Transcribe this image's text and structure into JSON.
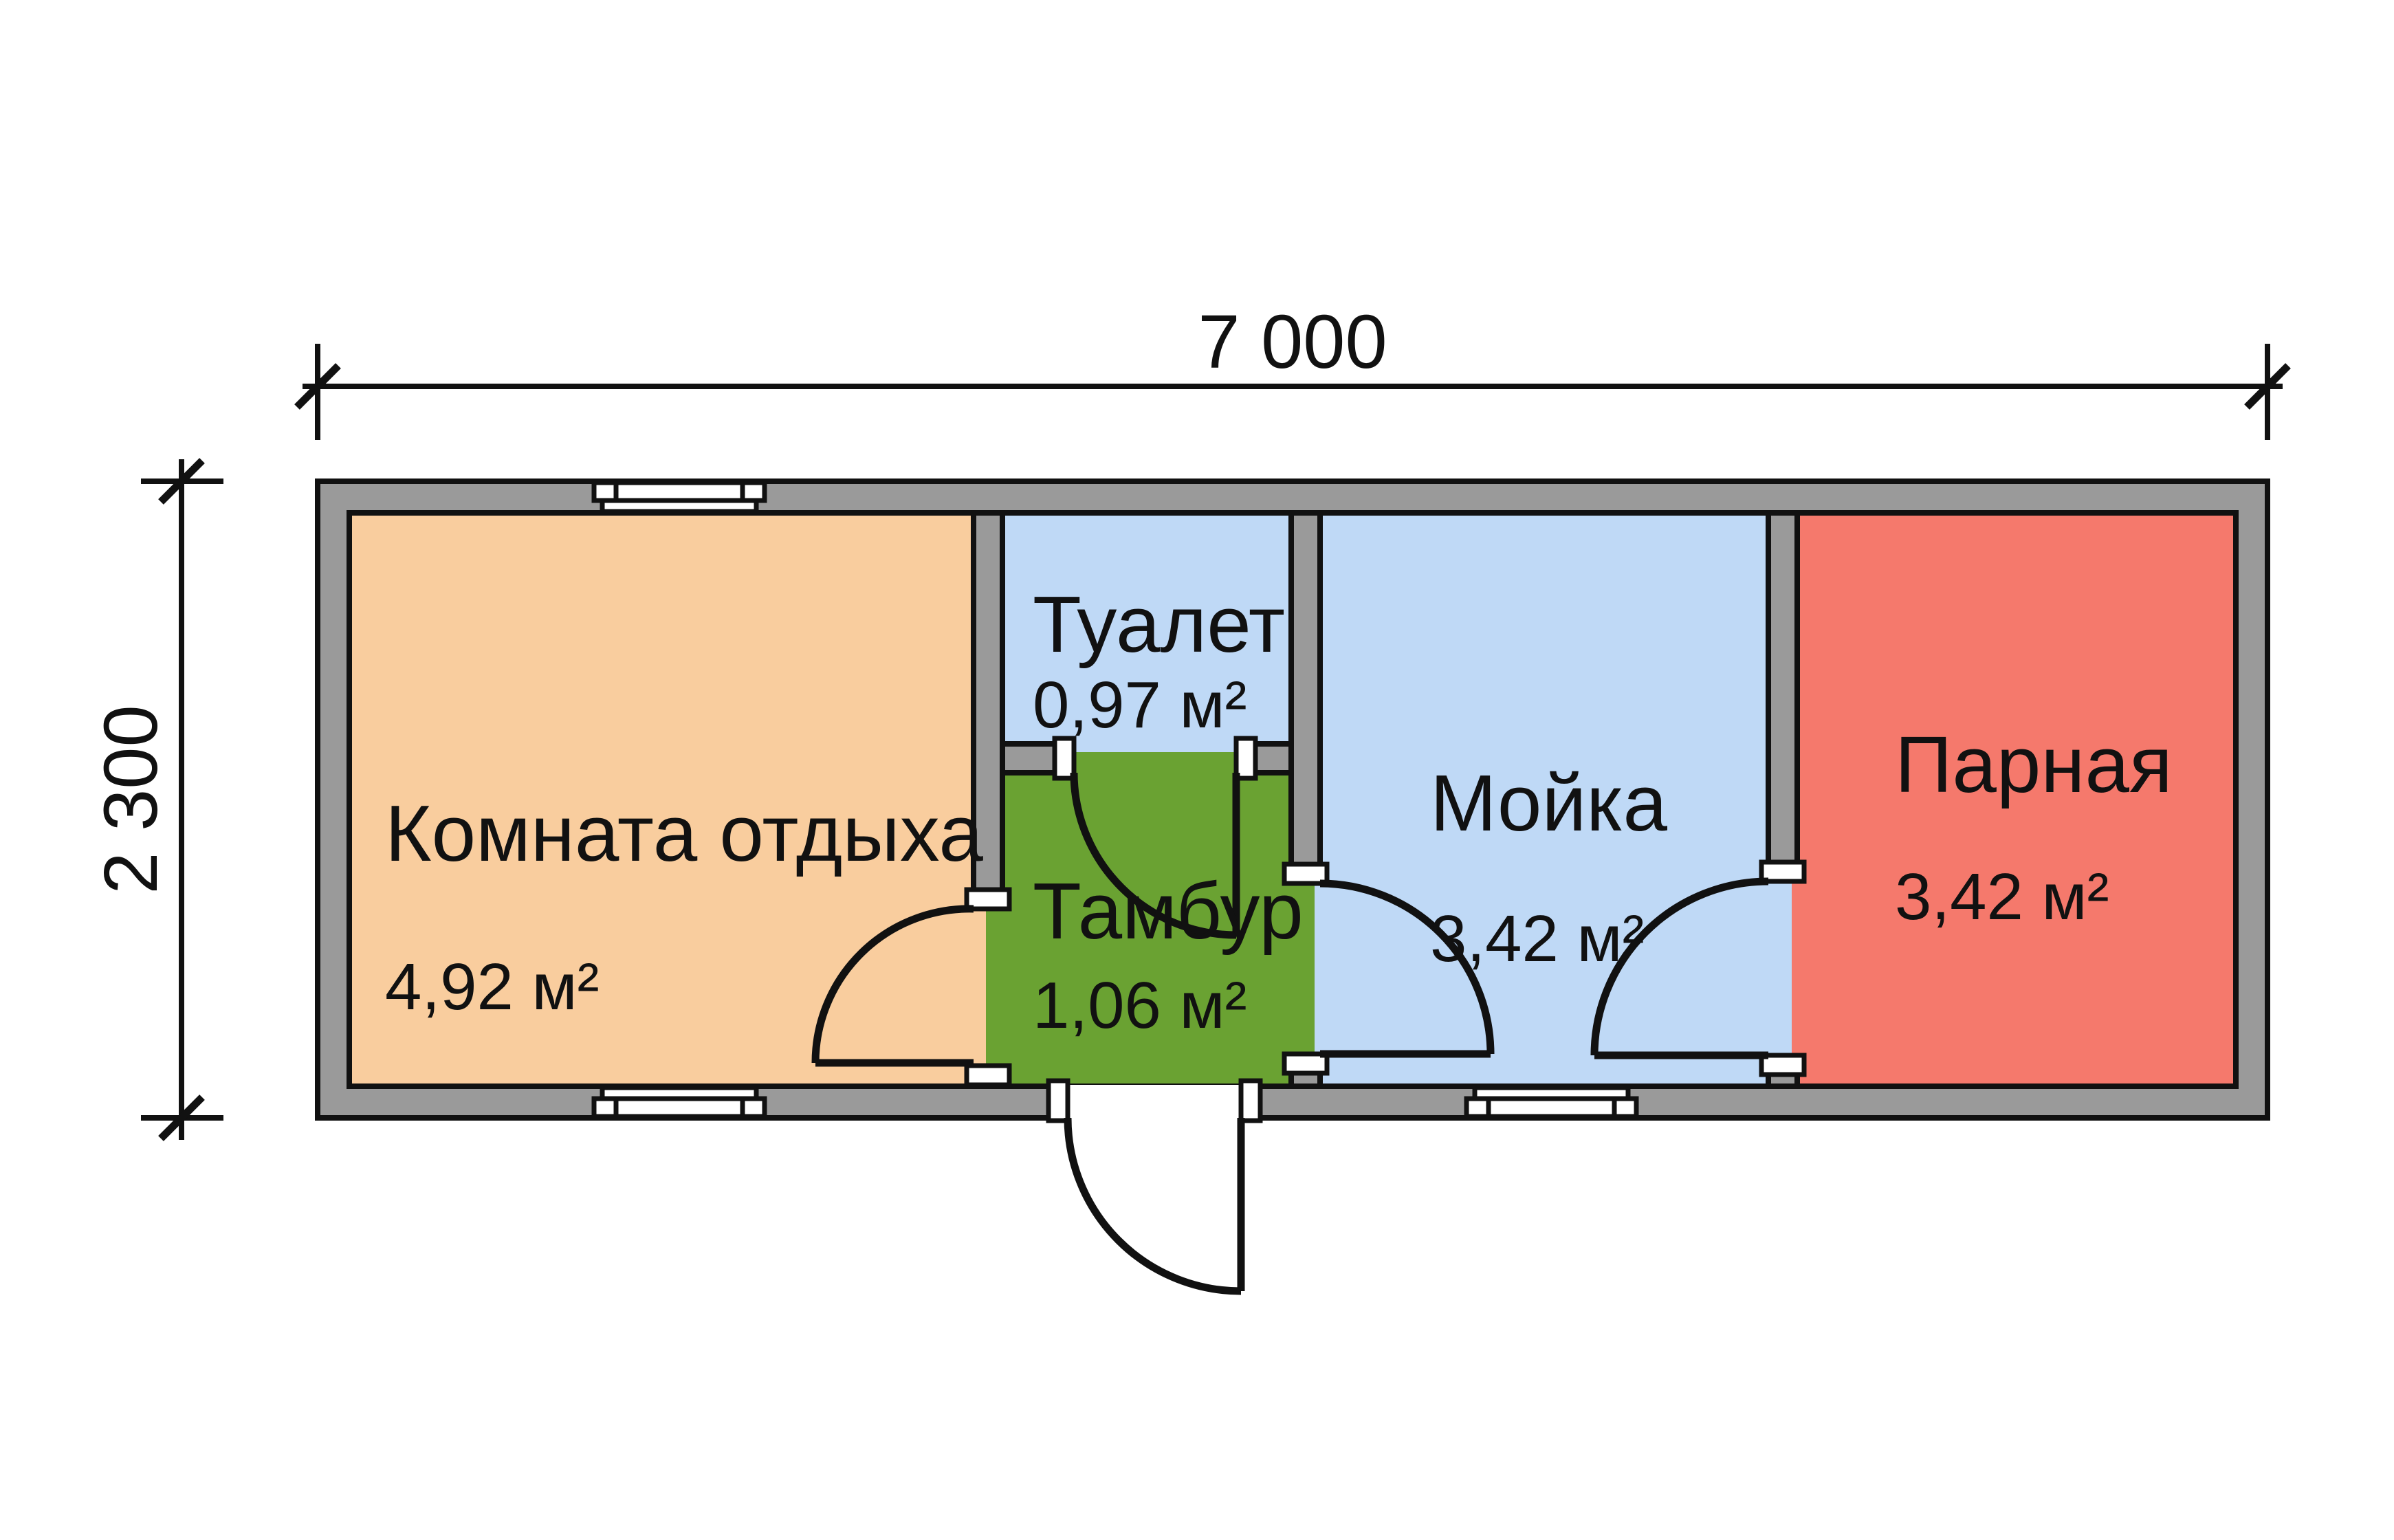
{
  "plan": {
    "dimensions": {
      "width_label": "7 000",
      "height_label": "2 300"
    },
    "rooms": [
      {
        "id": "lounge",
        "name": "Комната отдыха",
        "area": "4,92 м²"
      },
      {
        "id": "toilet",
        "name": "Туалет",
        "area": "0,97 м²"
      },
      {
        "id": "vestibule",
        "name": "Тамбур",
        "area": "1,06 м²"
      },
      {
        "id": "washroom",
        "name": "Мойка",
        "area": "3,42 м²"
      },
      {
        "id": "steam",
        "name": "Парная",
        "area": "3,42 м²"
      }
    ],
    "colors": {
      "lounge": "#F9CD9E",
      "wet": "#BFD9F6",
      "vestibule": "#6AA232",
      "steam": "#F5796C",
      "wall": "#9A9A9A",
      "line": "#111111",
      "background": "#FFFFFF"
    }
  }
}
